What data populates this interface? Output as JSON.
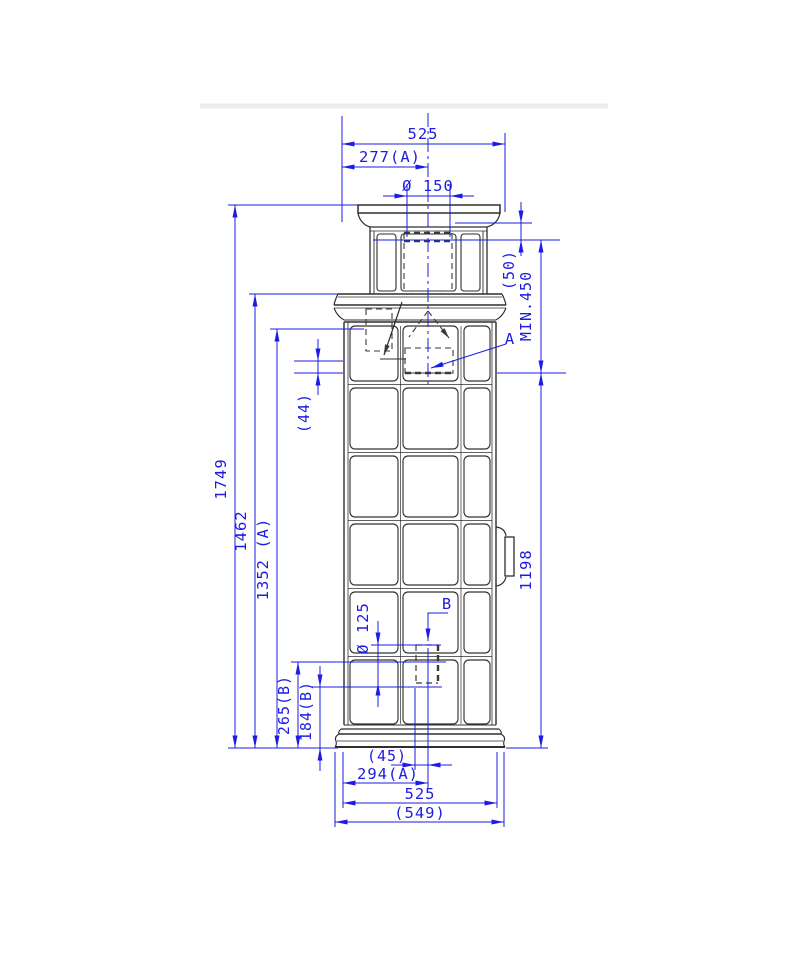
{
  "drawing": {
    "title": "tiled-stove-elevation-with-dimensions",
    "dimensions": {
      "top_width": "525",
      "top_width_to_center_a": "277(A)",
      "top_flue_diameter": "Ø 150",
      "cap_offset": "(50)",
      "min_clearance": "MIN.450",
      "rear_outlet_gap": "(44)",
      "total_height": "1749",
      "height_to_cornice": "1462",
      "height_to_outlet_a": "1352 (A)",
      "height_opening_a_to_floor": "1198",
      "side_flue_diameter": "Ø 125",
      "outlet_b_center_height": "265(B)",
      "outlet_b_bottom_height": "184(B)",
      "outlet_b_offset": "(45)",
      "bottom_width_to_center_a": "294(A)",
      "bottom_width": "525",
      "overall_width": "(549)"
    },
    "callouts": {
      "section_a": "A",
      "section_b": "B"
    },
    "colors": {
      "dimension_blue": "#1c1ce2",
      "linework_dark": "#2e2e2e"
    }
  }
}
